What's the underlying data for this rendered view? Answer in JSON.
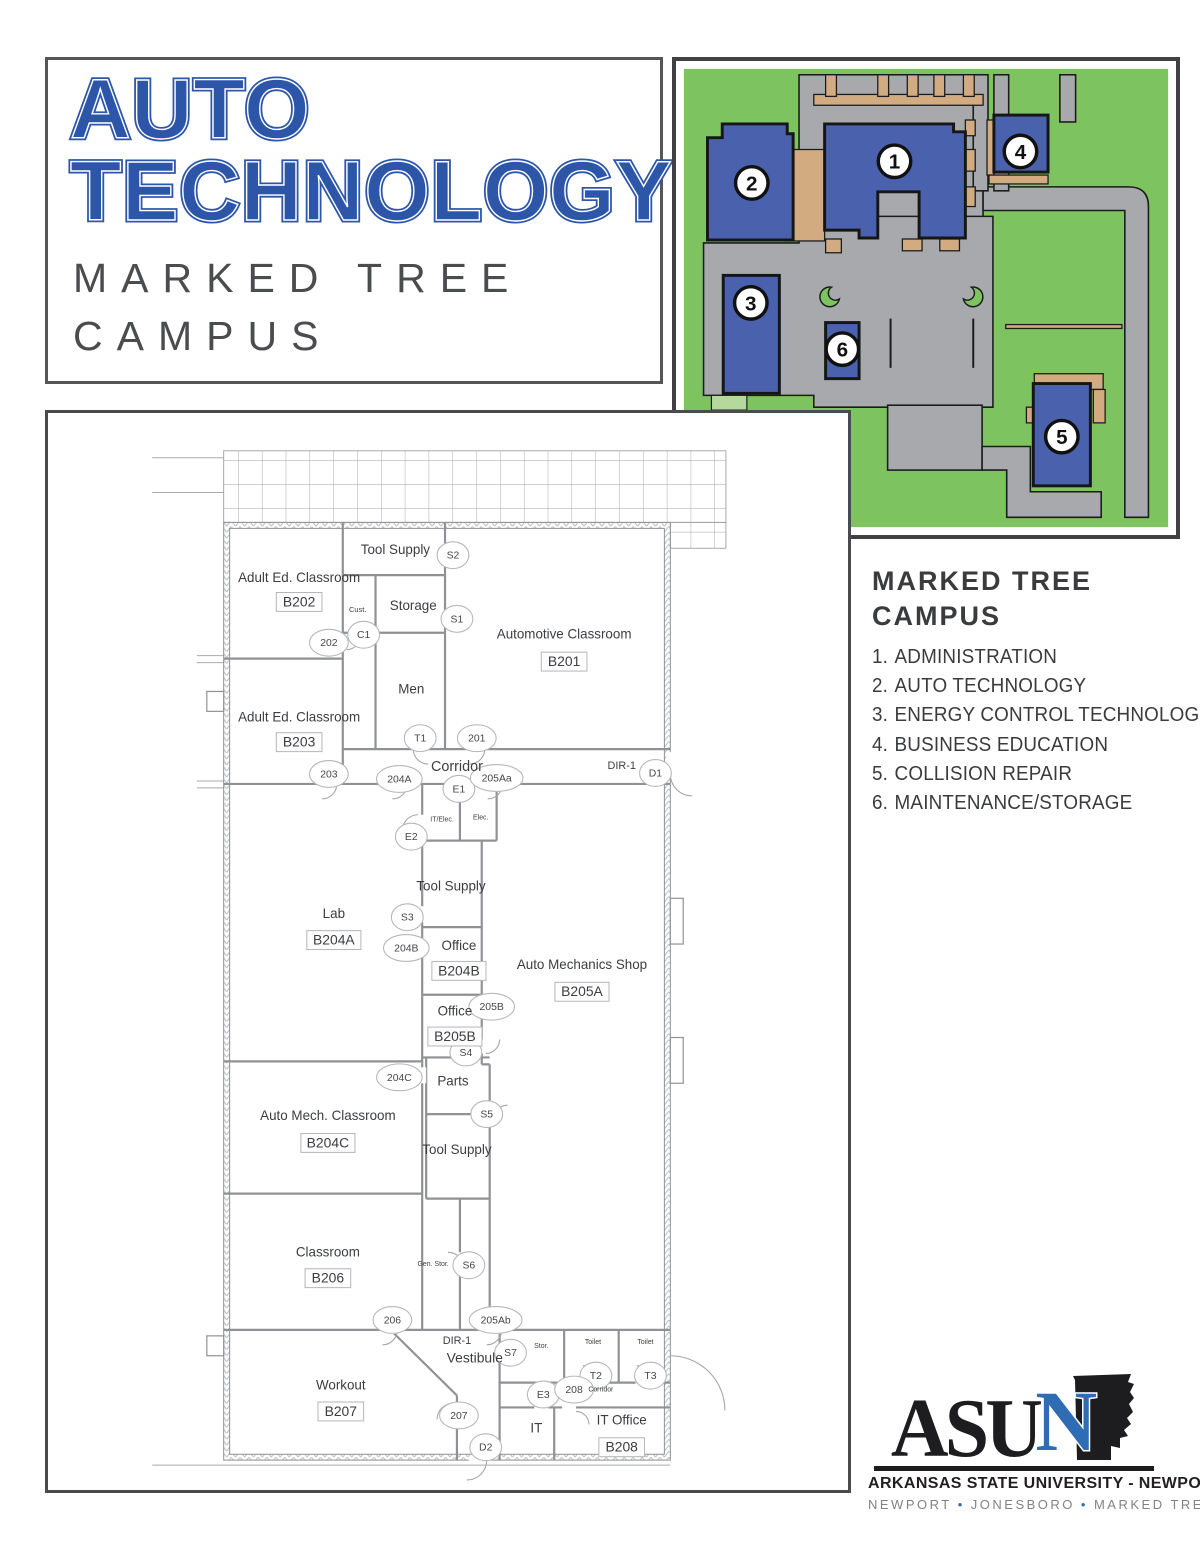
{
  "colors": {
    "title_blue": "#2d56a9",
    "map_green": "#7dc35f",
    "map_road_gray": "#a7a9ac",
    "map_walk_tan": "#d2ab80",
    "building_blue": "#4a62ae",
    "logo_blue": "#2e6db4",
    "text_dark": "#3a3b3d",
    "logo_gray": "#808285"
  },
  "title": {
    "line1": "AUTO",
    "line2": "TECHNOLOGY",
    "sub1": "MARKED TREE",
    "sub2": "CAMPUS"
  },
  "legend": {
    "heading_line1": "MARKED TREE",
    "heading_line2": "CAMPUS",
    "items": [
      {
        "number": "1",
        "label": "ADMINISTRATION"
      },
      {
        "number": "2",
        "label": "AUTO TECHNOLOGY"
      },
      {
        "number": "3",
        "label": "ENERGY CONTROL TECHNOLOGY"
      },
      {
        "number": "4",
        "label": "BUSINESS EDUCATION"
      },
      {
        "number": "5",
        "label": "COLLISION REPAIR"
      },
      {
        "number": "6",
        "label": "MAINTENANCE/STORAGE"
      }
    ]
  },
  "campus_map": {
    "buildings": [
      {
        "number": "1",
        "cx": 222,
        "cy": 102
      },
      {
        "number": "2",
        "cx": 77,
        "cy": 124
      },
      {
        "number": "3",
        "cx": 76,
        "cy": 246
      },
      {
        "number": "4",
        "cx": 350,
        "cy": 92
      },
      {
        "number": "5",
        "cx": 392,
        "cy": 382
      },
      {
        "number": "6",
        "cx": 169,
        "cy": 293
      }
    ]
  },
  "floorplan": {
    "rooms": [
      {
        "name": "Adult Ed. Classroom",
        "number": "B202",
        "name_x": 253,
        "name_y": 170,
        "num_x": 253,
        "num_y": 190
      },
      {
        "name": "Adult Ed. Classroom",
        "number": "B203",
        "name_x": 253,
        "name_y": 310,
        "num_x": 253,
        "num_y": 331
      },
      {
        "name": "Automotive Classroom",
        "number": "B201",
        "name_x": 520,
        "name_y": 227,
        "num_x": 520,
        "num_y": 250
      },
      {
        "name": "Lab",
        "number": "B204A",
        "name_x": 288,
        "name_y": 508,
        "num_x": 288,
        "num_y": 530
      },
      {
        "name": "Office",
        "number": "B204B",
        "name_x": 414,
        "name_y": 540,
        "num_x": 414,
        "num_y": 561
      },
      {
        "name": "Auto Mechanics Shop",
        "number": "B205A",
        "name_x": 538,
        "name_y": 559,
        "num_x": 538,
        "num_y": 582
      },
      {
        "name": "Office",
        "number": "B205B",
        "name_x": 410,
        "name_y": 606,
        "num_x": 410,
        "num_y": 627
      },
      {
        "name": "Auto Mech. Classroom",
        "number": "B204C",
        "name_x": 282,
        "name_y": 711,
        "num_x": 282,
        "num_y": 734
      },
      {
        "name": "Classroom",
        "number": "B206",
        "name_x": 282,
        "name_y": 848,
        "num_x": 282,
        "num_y": 870
      },
      {
        "name": "Workout",
        "number": "B207",
        "name_x": 295,
        "name_y": 982,
        "num_x": 295,
        "num_y": 1004
      },
      {
        "name": "IT Office",
        "number": "B208",
        "name_x": 578,
        "name_y": 1017,
        "num_x": 578,
        "num_y": 1040
      }
    ],
    "labels": [
      {
        "text": "Tool Supply",
        "x": 350,
        "y": 142,
        "size": 13.5
      },
      {
        "text": "Cust.",
        "x": 312,
        "y": 200,
        "size": 7.5
      },
      {
        "text": "Storage",
        "x": 368,
        "y": 198,
        "size": 13.5
      },
      {
        "text": "Men",
        "x": 366,
        "y": 282,
        "size": 13.5
      },
      {
        "text": "Corridor",
        "x": 412,
        "y": 360,
        "size": 14.5
      },
      {
        "text": "DIR-1",
        "x": 578,
        "y": 358,
        "size": 11
      },
      {
        "text": "IT/Elec.",
        "x": 397,
        "y": 411,
        "size": 7
      },
      {
        "text": "Elec.",
        "x": 436,
        "y": 409,
        "size": 7
      },
      {
        "text": "Tool Supply",
        "x": 406,
        "y": 480,
        "size": 13.5
      },
      {
        "text": "Parts",
        "x": 408,
        "y": 676,
        "size": 13.5
      },
      {
        "text": "Tool Supply",
        "x": 412,
        "y": 745,
        "size": 13.5
      },
      {
        "text": "Gen. Stor.",
        "x": 388,
        "y": 858,
        "size": 7
      },
      {
        "text": "DIR-1",
        "x": 412,
        "y": 936,
        "size": 11
      },
      {
        "text": "Vestibule",
        "x": 430,
        "y": 955,
        "size": 14
      },
      {
        "text": "Stor.",
        "x": 497,
        "y": 940,
        "size": 7
      },
      {
        "text": "Toilet",
        "x": 549,
        "y": 936,
        "size": 7
      },
      {
        "text": "Toilet",
        "x": 602,
        "y": 936,
        "size": 7
      },
      {
        "text": "Corridor",
        "x": 557,
        "y": 984,
        "size": 7
      },
      {
        "text": "IT",
        "x": 492,
        "y": 1025,
        "size": 13.5
      }
    ],
    "door_tags": [
      {
        "label": "S2",
        "x": 408,
        "y": 143
      },
      {
        "label": "S1",
        "x": 412,
        "y": 207
      },
      {
        "label": "C1",
        "x": 318,
        "y": 223
      },
      {
        "label": "202",
        "x": 283,
        "y": 231
      },
      {
        "label": "T1",
        "x": 375,
        "y": 327
      },
      {
        "label": "201",
        "x": 432,
        "y": 327
      },
      {
        "label": "203",
        "x": 283,
        "y": 363
      },
      {
        "label": "204A",
        "x": 354,
        "y": 368
      },
      {
        "label": "E1",
        "x": 414,
        "y": 378
      },
      {
        "label": "205Aa",
        "x": 452,
        "y": 367
      },
      {
        "label": "D1",
        "x": 612,
        "y": 362
      },
      {
        "label": "E2",
        "x": 366,
        "y": 426
      },
      {
        "label": "S3",
        "x": 362,
        "y": 507
      },
      {
        "label": "204B",
        "x": 361,
        "y": 538
      },
      {
        "label": "205B",
        "x": 447,
        "y": 597
      },
      {
        "label": "S4",
        "x": 421,
        "y": 643
      },
      {
        "label": "204C",
        "x": 354,
        "y": 668
      },
      {
        "label": "S5",
        "x": 442,
        "y": 705
      },
      {
        "label": "S6",
        "x": 424,
        "y": 857
      },
      {
        "label": "206",
        "x": 347,
        "y": 912
      },
      {
        "label": "205Ab",
        "x": 451,
        "y": 912
      },
      {
        "label": "S7",
        "x": 466,
        "y": 945
      },
      {
        "label": "T2",
        "x": 552,
        "y": 968
      },
      {
        "label": "T3",
        "x": 607,
        "y": 968
      },
      {
        "label": "E3",
        "x": 499,
        "y": 987
      },
      {
        "label": "208",
        "x": 530,
        "y": 982
      },
      {
        "label": "207",
        "x": 414,
        "y": 1008
      },
      {
        "label": "D2",
        "x": 441,
        "y": 1040
      }
    ]
  },
  "logo": {
    "wordmark_black": "ASU",
    "wordmark_blue": "N",
    "line1": "ARKANSAS STATE UNIVERSITY - NEWPORT",
    "bullet": "•",
    "campuses": [
      "NEWPORT",
      "JONESBORO",
      "MARKED TREE"
    ]
  }
}
